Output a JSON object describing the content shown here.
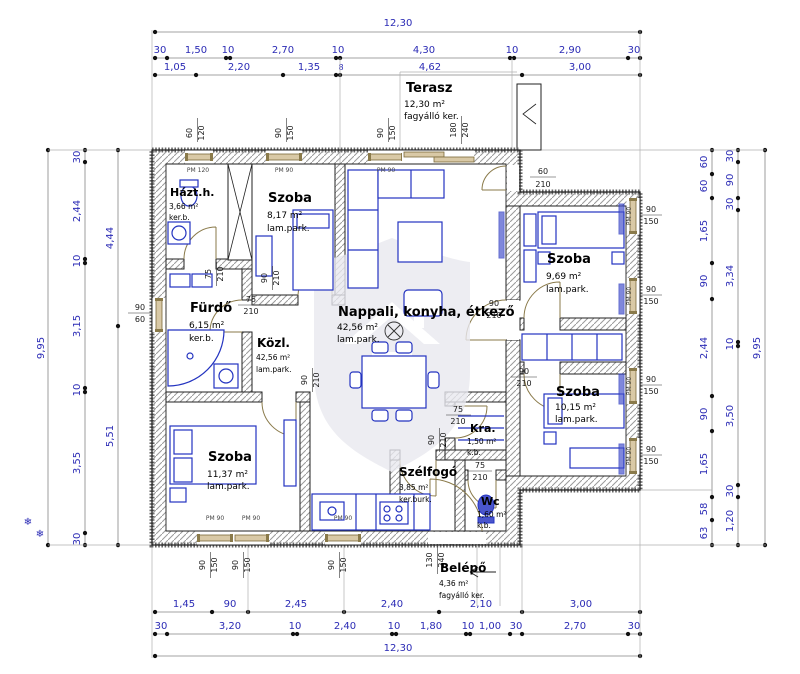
{
  "scene": {
    "type": "architectural-floor-plan",
    "language": "hu"
  },
  "colors": {
    "dimension_text": "#2b2bb5",
    "dimension_line": "#858585",
    "wall_outline": "#222222",
    "hatch": "#9a9a9a",
    "furniture": "#2333c0",
    "window_fill": "#d9c9a6",
    "door_arc": "#8a7a4a",
    "watermark": "#e9e9ef",
    "background": "#ffffff"
  },
  "rooms": {
    "terasz": {
      "name": "Terasz",
      "area": "12,30 m²",
      "finish": "fagyálló ker."
    },
    "hazth": {
      "name": "Házt.h.",
      "area": "3,66 m²",
      "finish": "ker.b."
    },
    "szoba1": {
      "name": "Szoba",
      "area": "8,17 m²",
      "finish": "lam.park."
    },
    "furdo": {
      "name": "Fürdő",
      "area": "6,15 m²",
      "finish": "ker.b."
    },
    "kozl": {
      "name": "Közl.",
      "area": "42,56 m²",
      "finish": "lam.park."
    },
    "nappali": {
      "name": "Nappali,  konyha,  étkező",
      "area": "42,56 m²",
      "finish": "lam.park."
    },
    "szoba2": {
      "name": "Szoba",
      "area": "9,69 m²",
      "finish": "lam.park."
    },
    "szoba3": {
      "name": "Szoba",
      "area": "10,15 m²",
      "finish": "lam.park."
    },
    "szoba4": {
      "name": "Szoba",
      "area": "11,37 m²",
      "finish": "lam.park."
    },
    "kamra": {
      "name": "Kra.",
      "area": "1,50 m²",
      "finish": "k.b."
    },
    "szelfogo": {
      "name": "Szélfogó",
      "area": "3,85 m²",
      "finish": "ker.burk."
    },
    "wc": {
      "name": "Wc",
      "area": "1,60 m²",
      "finish": "k.b."
    },
    "belepo": {
      "name": "Belépő",
      "area": "4,36 m²",
      "finish": "fagyálló ker."
    }
  },
  "dims": {
    "top_total": "12,30",
    "top_row1": [
      "30",
      "1,50",
      "10",
      "2,70",
      "10",
      "4,30",
      "10",
      "2,90",
      "30"
    ],
    "top_row2": [
      "1,05",
      "2,20",
      "1,35",
      "8",
      "4,62",
      "3,00"
    ],
    "left_outer": "9,95",
    "left_row": [
      "30",
      "2,44",
      "10",
      "3,15",
      "10",
      "3,55",
      "30"
    ],
    "left_inner": [
      "4,44",
      "5,51"
    ],
    "right_inner": [
      "60",
      "60",
      "1,65",
      "90",
      "2,44",
      "90",
      "1,65",
      "58",
      "63"
    ],
    "right_mid": [
      "30",
      "90",
      "30",
      "3,34",
      "10",
      "3,50",
      "30",
      "1,20"
    ],
    "right_outer": "9,95",
    "bottom_row1": [
      "1,45",
      "90",
      "2,45",
      "2,40",
      "2,10",
      "3,00"
    ],
    "bottom_row2": [
      "30",
      "3,20",
      "10",
      "2,40",
      "10",
      "1,80",
      "10",
      "1,00",
      "30",
      "2,70",
      "30"
    ],
    "bottom_total": "12,30"
  },
  "openings": {
    "pm120": "PM 120",
    "pm90": "PM 90",
    "w60_120": [
      "60",
      "120"
    ],
    "w90_150": [
      "90",
      "150"
    ],
    "w90_60": [
      "90",
      "60"
    ],
    "d180_240": [
      "180",
      "240"
    ],
    "d60_210": [
      "60",
      "210"
    ],
    "d75_210": [
      "75",
      "210"
    ],
    "d90_210": [
      "90",
      "210"
    ],
    "d130_240": [
      "130",
      "240"
    ]
  },
  "symbols": {
    "snowflake": "❄"
  }
}
